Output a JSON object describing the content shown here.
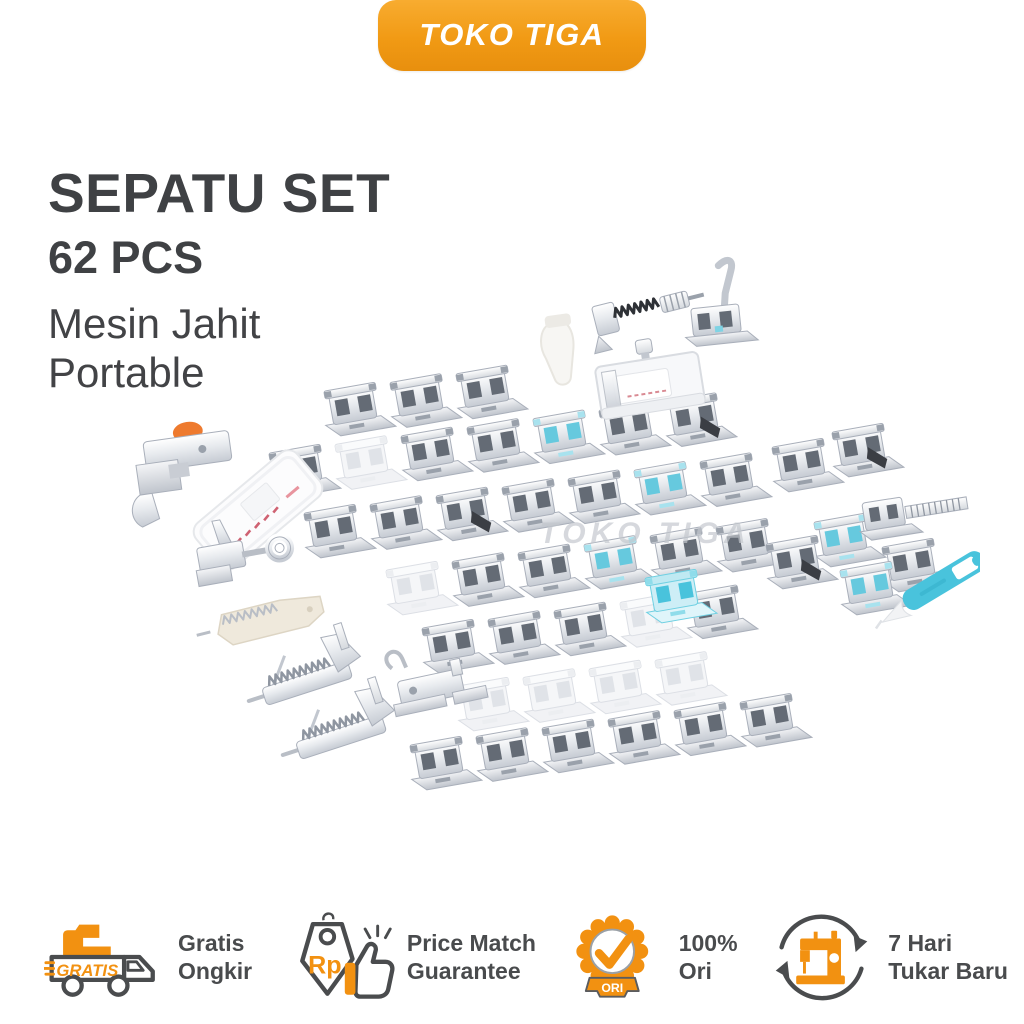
{
  "brand": {
    "name": "TOKO TIGA"
  },
  "title": {
    "heading": "SEPATU SET",
    "subheading": "62 PCS",
    "line3": "Mesin Jahit",
    "line4": "Portable"
  },
  "product": {
    "watermark": "TOKO TIGA"
  },
  "features": [
    {
      "id": "free-shipping",
      "icon": "free-shipping-truck-icon",
      "icon_text": "GRATIS",
      "line1": "Gratis",
      "line2": "Ongkir"
    },
    {
      "id": "price-match",
      "icon": "price-tag-thumbs-up-icon",
      "icon_text": "Rp",
      "line1": "Price Match",
      "line2": "Guarantee"
    },
    {
      "id": "original",
      "icon": "original-seal-icon",
      "icon_text": "ORI",
      "line1": "100%",
      "line2": "Ori"
    },
    {
      "id": "exchange",
      "icon": "sewing-machine-exchange-icon",
      "icon_text": "",
      "line1": "7 Hari",
      "line2": "Tukar Baru"
    }
  ],
  "colors": {
    "accent_orange": "#F29111",
    "badge_gradient_top": "#F8AC30",
    "badge_gradient_bottom": "#E88F0E",
    "dark_text": "#3F4144",
    "feature_text": "#494B4D",
    "watermark_gray": "#C6CAD0",
    "ripper_teal": "#49C3DC",
    "knob_orange": "#EE7A2E"
  }
}
